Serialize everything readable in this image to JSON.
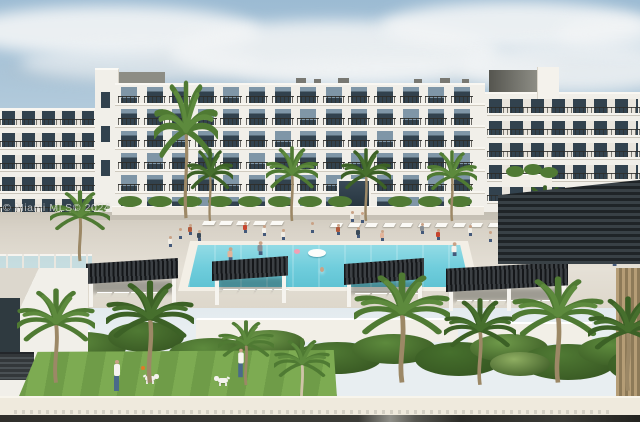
{
  "photo": {
    "watermark": "© Miami MLS© 2024",
    "alt": "Rendering of a white mid-rise condominium with a central swimming pool, slatted cabana pergolas, palm landscaping and a fenced lawn dog run in the foreground"
  },
  "colors": {
    "sky_top": "#9cbbd3",
    "sky_mid": "#c3d6e2",
    "sky_low": "#e8eef1",
    "cloud": "#f3f5f6",
    "cloud_gray": "#b4c0c9",
    "facade": "#f1efe9",
    "facade_shade": "#dcd7cd",
    "roofbox": "#8d8d85",
    "window_glass": "#32424e",
    "window_light": "#7f96a7",
    "rail": "#3b3b37",
    "deck": "#d8d2c7",
    "deck_light": "#e5e0d6",
    "pool_coping": "#f3efe6",
    "pool_water": "#6fcddc",
    "pool_light": "#b7eaf0",
    "pergola": "#24272a",
    "post": "#f6f4ef",
    "palm": "#5d8a3d",
    "palm_dark": "#466f2d",
    "shrub": "#507a34",
    "trunk": "#9c8866",
    "lawn": "#6f9c48",
    "lawn_stripe": "#7dab52",
    "planter": "#f2efe7",
    "wall": "#efeadd",
    "strip_dark": "#302f2b",
    "strip_light": "#8f8f88",
    "skin": "#c9a286"
  }
}
